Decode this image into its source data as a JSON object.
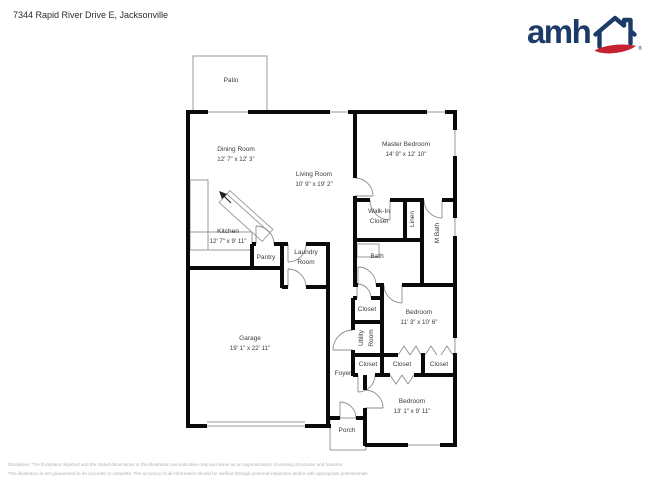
{
  "header": {
    "address": "7344 Rapid River Drive E, Jacksonville"
  },
  "logo": {
    "brand": "amh",
    "registered": "®",
    "brand_blue": "#1c3b69",
    "brand_red": "#c62331"
  },
  "rooms": {
    "patio": {
      "name": "Patio"
    },
    "dining": {
      "name": "Dining Room",
      "dims": "12' 7\" x 12' 3\""
    },
    "living": {
      "name": "Living Room",
      "dims": "10' 9\" x 19' 2\""
    },
    "master": {
      "name": "Master Bedroom",
      "dims": "14' 9\" x 12' 10\""
    },
    "kitchen": {
      "name": "Kitchen",
      "dims": "12' 7\" x 9' 11\""
    },
    "walkin": {
      "name": "Walk-In Closet"
    },
    "linen": {
      "name": "Linen"
    },
    "mbath": {
      "name": "M Bath"
    },
    "pantry": {
      "name": "Pantry"
    },
    "laundry": {
      "name": "Laundry Room"
    },
    "bath": {
      "name": "Bath"
    },
    "garage": {
      "name": "Garage",
      "dims": "19' 1\" x 22' 11\""
    },
    "closet1": {
      "name": "Closet"
    },
    "bedroom2": {
      "name": "Bedroom",
      "dims": "11' 3\" x 10' 6\""
    },
    "utility": {
      "name": "Utility Room"
    },
    "closet2": {
      "name": "Closet"
    },
    "closet3": {
      "name": "Closet"
    },
    "closet4": {
      "name": "Closet"
    },
    "foyer": {
      "name": "Foyer"
    },
    "bedroom3": {
      "name": "Bedroom",
      "dims": "13' 1\" x 9' 11\""
    },
    "porch": {
      "name": "Porch"
    }
  },
  "disclaimer": {
    "line1": "Disclaimer: The floorplans depicted and the stated dimensions in this illustration are indicative only and serve as an approximation of existing structures and features.",
    "line2": "This illustration is not guaranteed to be accurate or complete. The accuracy of all information should be verified through personal inspection and/or with appropriate professionals."
  }
}
